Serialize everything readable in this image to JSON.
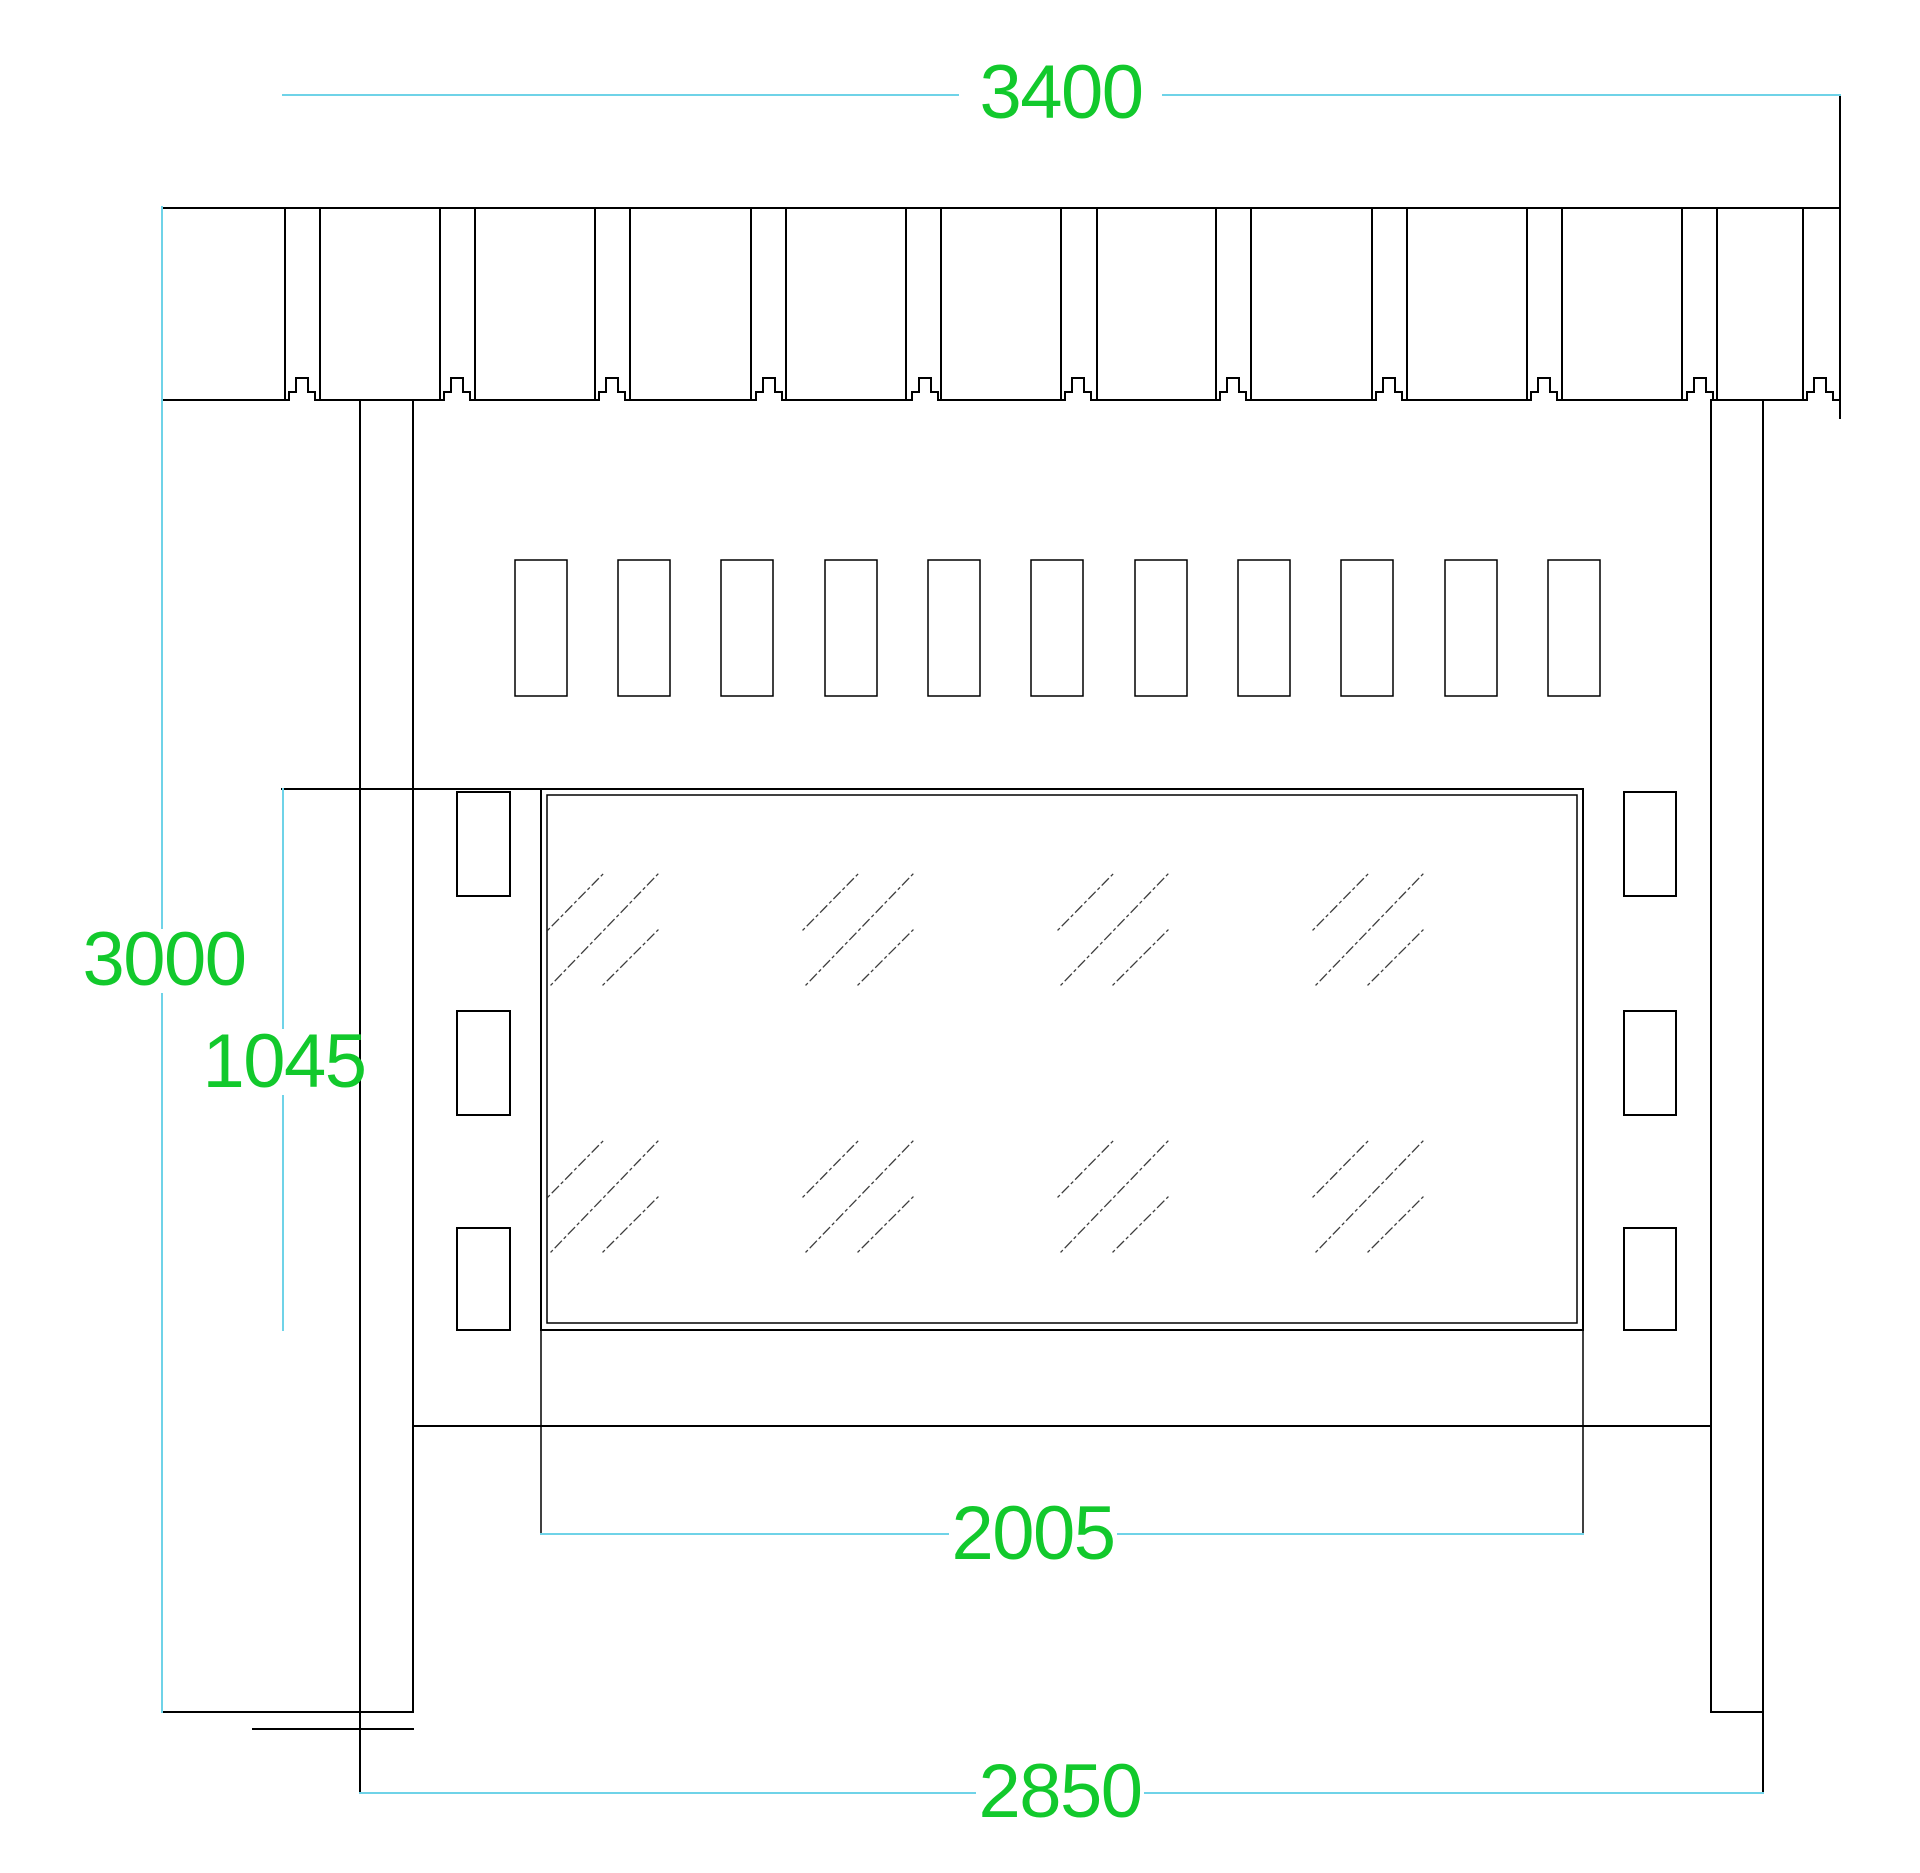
{
  "drawing": {
    "kind": "cad-elevation",
    "canvas": {
      "width": 1920,
      "height": 1873,
      "background": "#ffffff"
    }
  },
  "colors": {
    "outline": "#000000",
    "dimension_line": "#6fd3e8",
    "dimension_text": "#12c92c",
    "hatch": "#3c3c3c"
  },
  "labels": {
    "overall_width": {
      "value": "3400",
      "cx": 1061,
      "cy": 93
    },
    "overall_height": {
      "value": "3000",
      "cx": 164,
      "cy": 960
    },
    "glass_height": {
      "value": "1045",
      "cx": 284,
      "cy": 1062
    },
    "glass_width": {
      "value": "2005",
      "cx": 1033,
      "cy": 1534
    },
    "post_span": {
      "value": "2850",
      "cx": 1060,
      "cy": 1792
    }
  },
  "geometry": {
    "roof_band": {
      "x1": 162,
      "x2": 1840,
      "top": 208,
      "bottom": 400,
      "right_edge": [
        1840,
        96,
        1840,
        418
      ],
      "verticals": [
        285,
        320,
        440,
        475,
        595,
        630,
        751,
        786,
        906,
        941,
        1061,
        1097,
        1216,
        1251,
        1372,
        1407,
        1527,
        1562,
        1682,
        1717,
        1803
      ],
      "bump_centers": [
        302,
        457,
        612,
        769,
        925,
        1078,
        1233,
        1389,
        1544,
        1700,
        1820
      ],
      "bump": {
        "half_width": 13,
        "shoulder_half": 6,
        "shoulder_rise": 8,
        "rise": 22
      }
    },
    "posts": {
      "left": [
        [
          360,
          400,
          360,
          1793
        ],
        [
          413,
          400,
          413,
          1712
        ]
      ],
      "right": [
        [
          1711,
          400,
          1711,
          1712
        ],
        [
          1763,
          400,
          1763,
          1793
        ]
      ]
    },
    "rails": [
      [
        282,
        789,
        1583,
        789
      ],
      [
        413,
        1426,
        1711,
        1426
      ],
      [
        163,
        1712,
        413,
        1712
      ],
      [
        1711,
        1712,
        1763,
        1712
      ],
      [
        253,
        1729,
        413,
        1729
      ]
    ],
    "glass": {
      "outer": {
        "x": 541,
        "y": 789,
        "w": 1042,
        "h": 541
      },
      "inner": {
        "x": 547,
        "y": 795,
        "w": 1030,
        "h": 528
      },
      "extension_lines": [
        [
          541,
          1330,
          541,
          1534
        ],
        [
          1583,
          1330,
          1583,
          1534
        ]
      ],
      "hatch": {
        "group_cols": [
          548,
          803,
          1058,
          1313
        ],
        "group_rows": [
          873,
          1140
        ],
        "strokes": [
          [
            0,
            57,
            56,
            0
          ],
          [
            3,
            112,
            110,
            1
          ],
          [
            55,
            112,
            110,
            57
          ]
        ]
      }
    },
    "purlin_row": {
      "xs": [
        515,
        618,
        721,
        825,
        928,
        1031,
        1135,
        1238,
        1341,
        1445,
        1548
      ],
      "y": 560,
      "w": 52,
      "h": 136
    },
    "brackets": {
      "left_x": 457,
      "left_w": 53,
      "right_x": 1624,
      "right_w": 52,
      "rows": [
        [
          792,
          104
        ],
        [
          1011,
          104
        ],
        [
          1228,
          102
        ]
      ]
    },
    "dimension_lines": [
      [
        283,
        95,
        958,
        95
      ],
      [
        1163,
        95,
        1840,
        95
      ],
      [
        162,
        207,
        162,
        928
      ],
      [
        162,
        994,
        162,
        1712
      ],
      [
        283,
        789,
        283,
        1028
      ],
      [
        283,
        1096,
        283,
        1330
      ],
      [
        541,
        1534,
        948,
        1534
      ],
      [
        1118,
        1534,
        1583,
        1534
      ],
      [
        360,
        1793,
        975,
        1793
      ],
      [
        1145,
        1793,
        1763,
        1793
      ]
    ]
  }
}
